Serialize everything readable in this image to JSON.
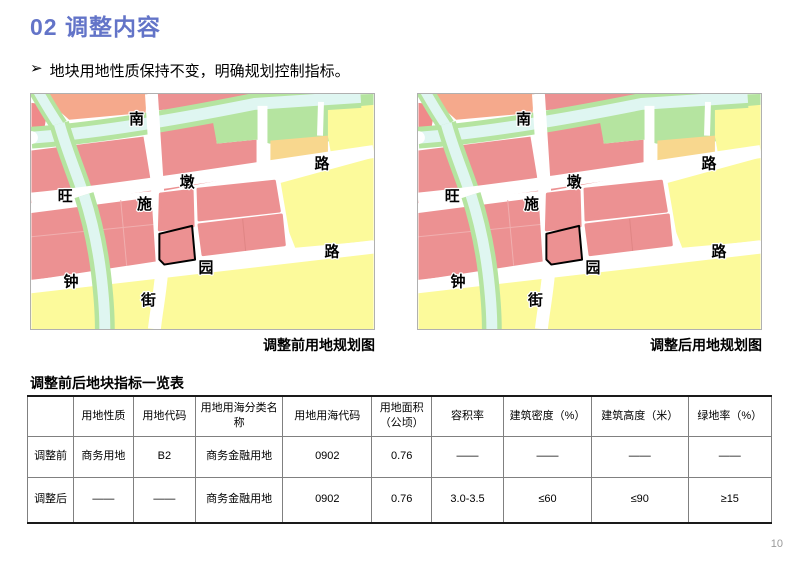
{
  "page": {
    "title": "02 调整内容",
    "bullet_marker": "➢",
    "bullet": "地块用地性质保持不变，明确规划控制指标。",
    "page_number": "10",
    "accent_color": "#6374C8"
  },
  "maps": {
    "before_caption": "调整前用地规划图",
    "after_caption": "调整后用地规划图",
    "road_labels": {
      "nan": "南",
      "shi": "施",
      "jie": "街",
      "wang": "旺",
      "dun": "墩",
      "lu_ne": "路",
      "zhong": "钟",
      "yuan": "园",
      "lu_se": "路"
    },
    "colors": {
      "residential_pink": "#EC9192",
      "salmon_block": "#F5A98C",
      "rose_block": "#EF8A8A",
      "commercial_yellow": "#FCFA9B",
      "orange_block": "#F8D78E",
      "green_space": "#B5E4A0",
      "water": "#DFF6F1",
      "road": "#FFFFFF",
      "subject_parcel_outline": "#000000"
    }
  },
  "table": {
    "title": "调整前后地块指标一览表",
    "headers": [
      "",
      "用地性质",
      "用地代码",
      "用地用海分类名称",
      "用地用海代码",
      "用地面积（公顷）",
      "容积率",
      "建筑密度（%）",
      "建筑高度（米）",
      "绿地率（%）"
    ],
    "rows": [
      {
        "label": "调整前",
        "cells": [
          "商务用地",
          "B2",
          "商务金融用地",
          "0902",
          "0.76",
          "——",
          "——",
          "——",
          "——"
        ]
      },
      {
        "label": "调整后",
        "cells": [
          "——",
          "——",
          "商务金融用地",
          "0902",
          "0.76",
          "3.0-3.5",
          "≤60",
          "≤90",
          "≥15"
        ]
      }
    ]
  }
}
